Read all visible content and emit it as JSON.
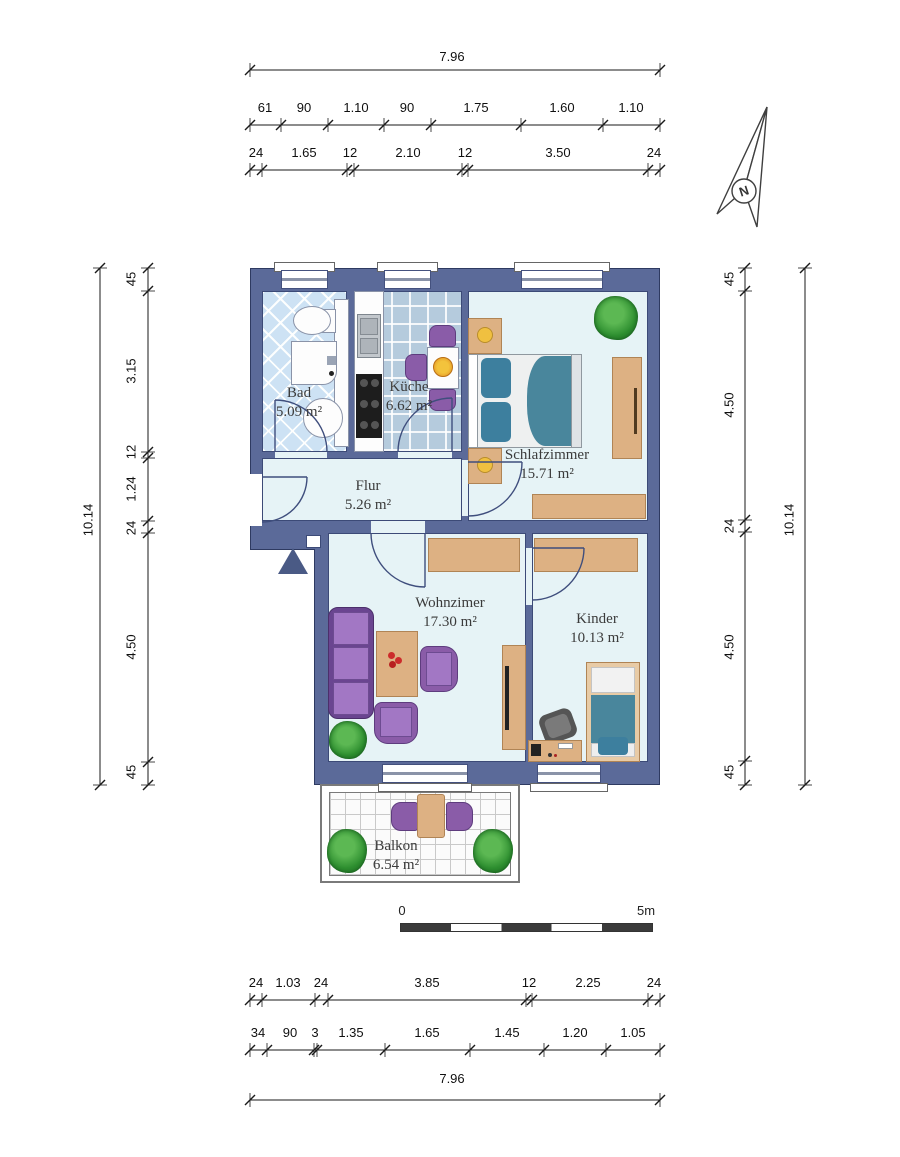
{
  "dimensions": {
    "top_total": "7.96",
    "top_row2": [
      "61",
      "90",
      "1.10",
      "90",
      "1.75",
      "1.60",
      "1.10"
    ],
    "top_row3": [
      "24",
      "1.65",
      "12",
      "2.10",
      "12",
      "3.50",
      "24"
    ],
    "left_total": "10.14",
    "left_segments": [
      "45",
      "3.15",
      "12",
      "1.24",
      "24",
      "4.50",
      "45"
    ],
    "right_total": "10.14",
    "right_segments": [
      "45",
      "4.50",
      "24",
      "4.50",
      "45"
    ],
    "bottom_row1": [
      "24",
      "1.03",
      "24",
      "3.85",
      "12",
      "2.25",
      "24"
    ],
    "bottom_row2": [
      "34",
      "90",
      "3",
      "1.35",
      "1.65",
      "1.45",
      "1.20",
      "1.05"
    ],
    "bottom_total": "7.96"
  },
  "rooms": {
    "bad": {
      "name": "Bad",
      "area": "5.09 m²"
    },
    "kueche": {
      "name": "Küche",
      "area": "6.62 m²"
    },
    "schlafzimmer": {
      "name": "Schlafzimmer",
      "area": "15.71 m²"
    },
    "flur": {
      "name": "Flur",
      "area": "5.26 m²"
    },
    "wohnzimmer": {
      "name": "Wohnzimer",
      "area": "17.30 m²"
    },
    "kinder": {
      "name": "Kinder",
      "area": "10.13 m²"
    },
    "balkon": {
      "name": "Balkon",
      "area": "6.54 m²"
    }
  },
  "scale_bar": {
    "start": "0",
    "end": "5m"
  },
  "compass": {
    "label": "N"
  },
  "colors": {
    "wall": "#5b6a99",
    "floor": "#e6f3f6",
    "furniture_wood": "#ddb183",
    "sofa_purple": "#8a5ca8",
    "bedding_teal": "#49869c",
    "bad_tiles": "#cde2f4",
    "kueche_tiles": "#b5cbdd"
  }
}
